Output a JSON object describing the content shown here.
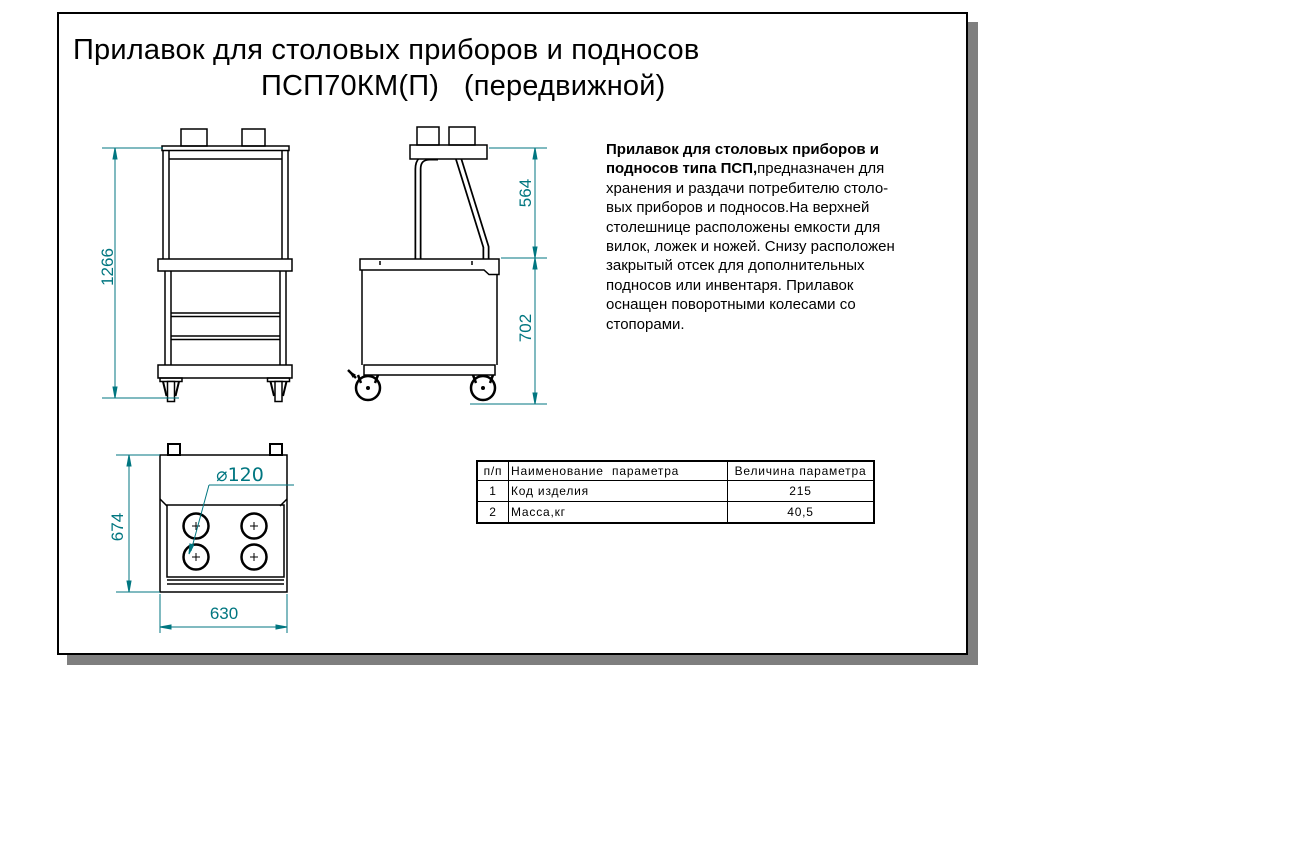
{
  "page": {
    "title_line1": "Прилавок для столовых приборов и подносов",
    "title_line2": "ПСП70КМ(П)   (передвижной)"
  },
  "description": {
    "lines": [
      {
        "b": "Прилавок для столовых приборов и",
        "t": ""
      },
      {
        "b": "подносов типа ПСП,",
        "t": "предназначен для"
      },
      {
        "b": "",
        "t": "хранения и раздачи потребителю столо-"
      },
      {
        "b": "",
        "t": "вых приборов и подносов.На верхней"
      },
      {
        "b": "",
        "t": "столешнице расположены емкости для"
      },
      {
        "b": "",
        "t": "вилок, ложек и ножей. Снизу расположен"
      },
      {
        "b": "",
        "t": "закрытый отсек для дополнительных"
      },
      {
        "b": "",
        "t": "подносов или инвентаря. Прилавок"
      },
      {
        "b": "",
        "t": "оснащен поворотными колесами со"
      },
      {
        "b": "",
        "t": "стопорами."
      }
    ]
  },
  "dimensions": {
    "front_height": "1266",
    "side_upper_height": "564",
    "side_body_height": "702",
    "top_depth": "674",
    "top_width": "630",
    "hole_diameter": "⌀120"
  },
  "table": {
    "headers": {
      "num": "п/п",
      "name": "Наименование  параметра",
      "value": "Величина параметра"
    },
    "rows": [
      {
        "num": "1",
        "name": "Код изделия",
        "value": "215"
      },
      {
        "num": "2",
        "name": "Масса,кг",
        "value": "40,5"
      }
    ]
  },
  "colors": {
    "dimension": "#007680",
    "line": "#000000",
    "shadow": "#7f7f7f"
  }
}
